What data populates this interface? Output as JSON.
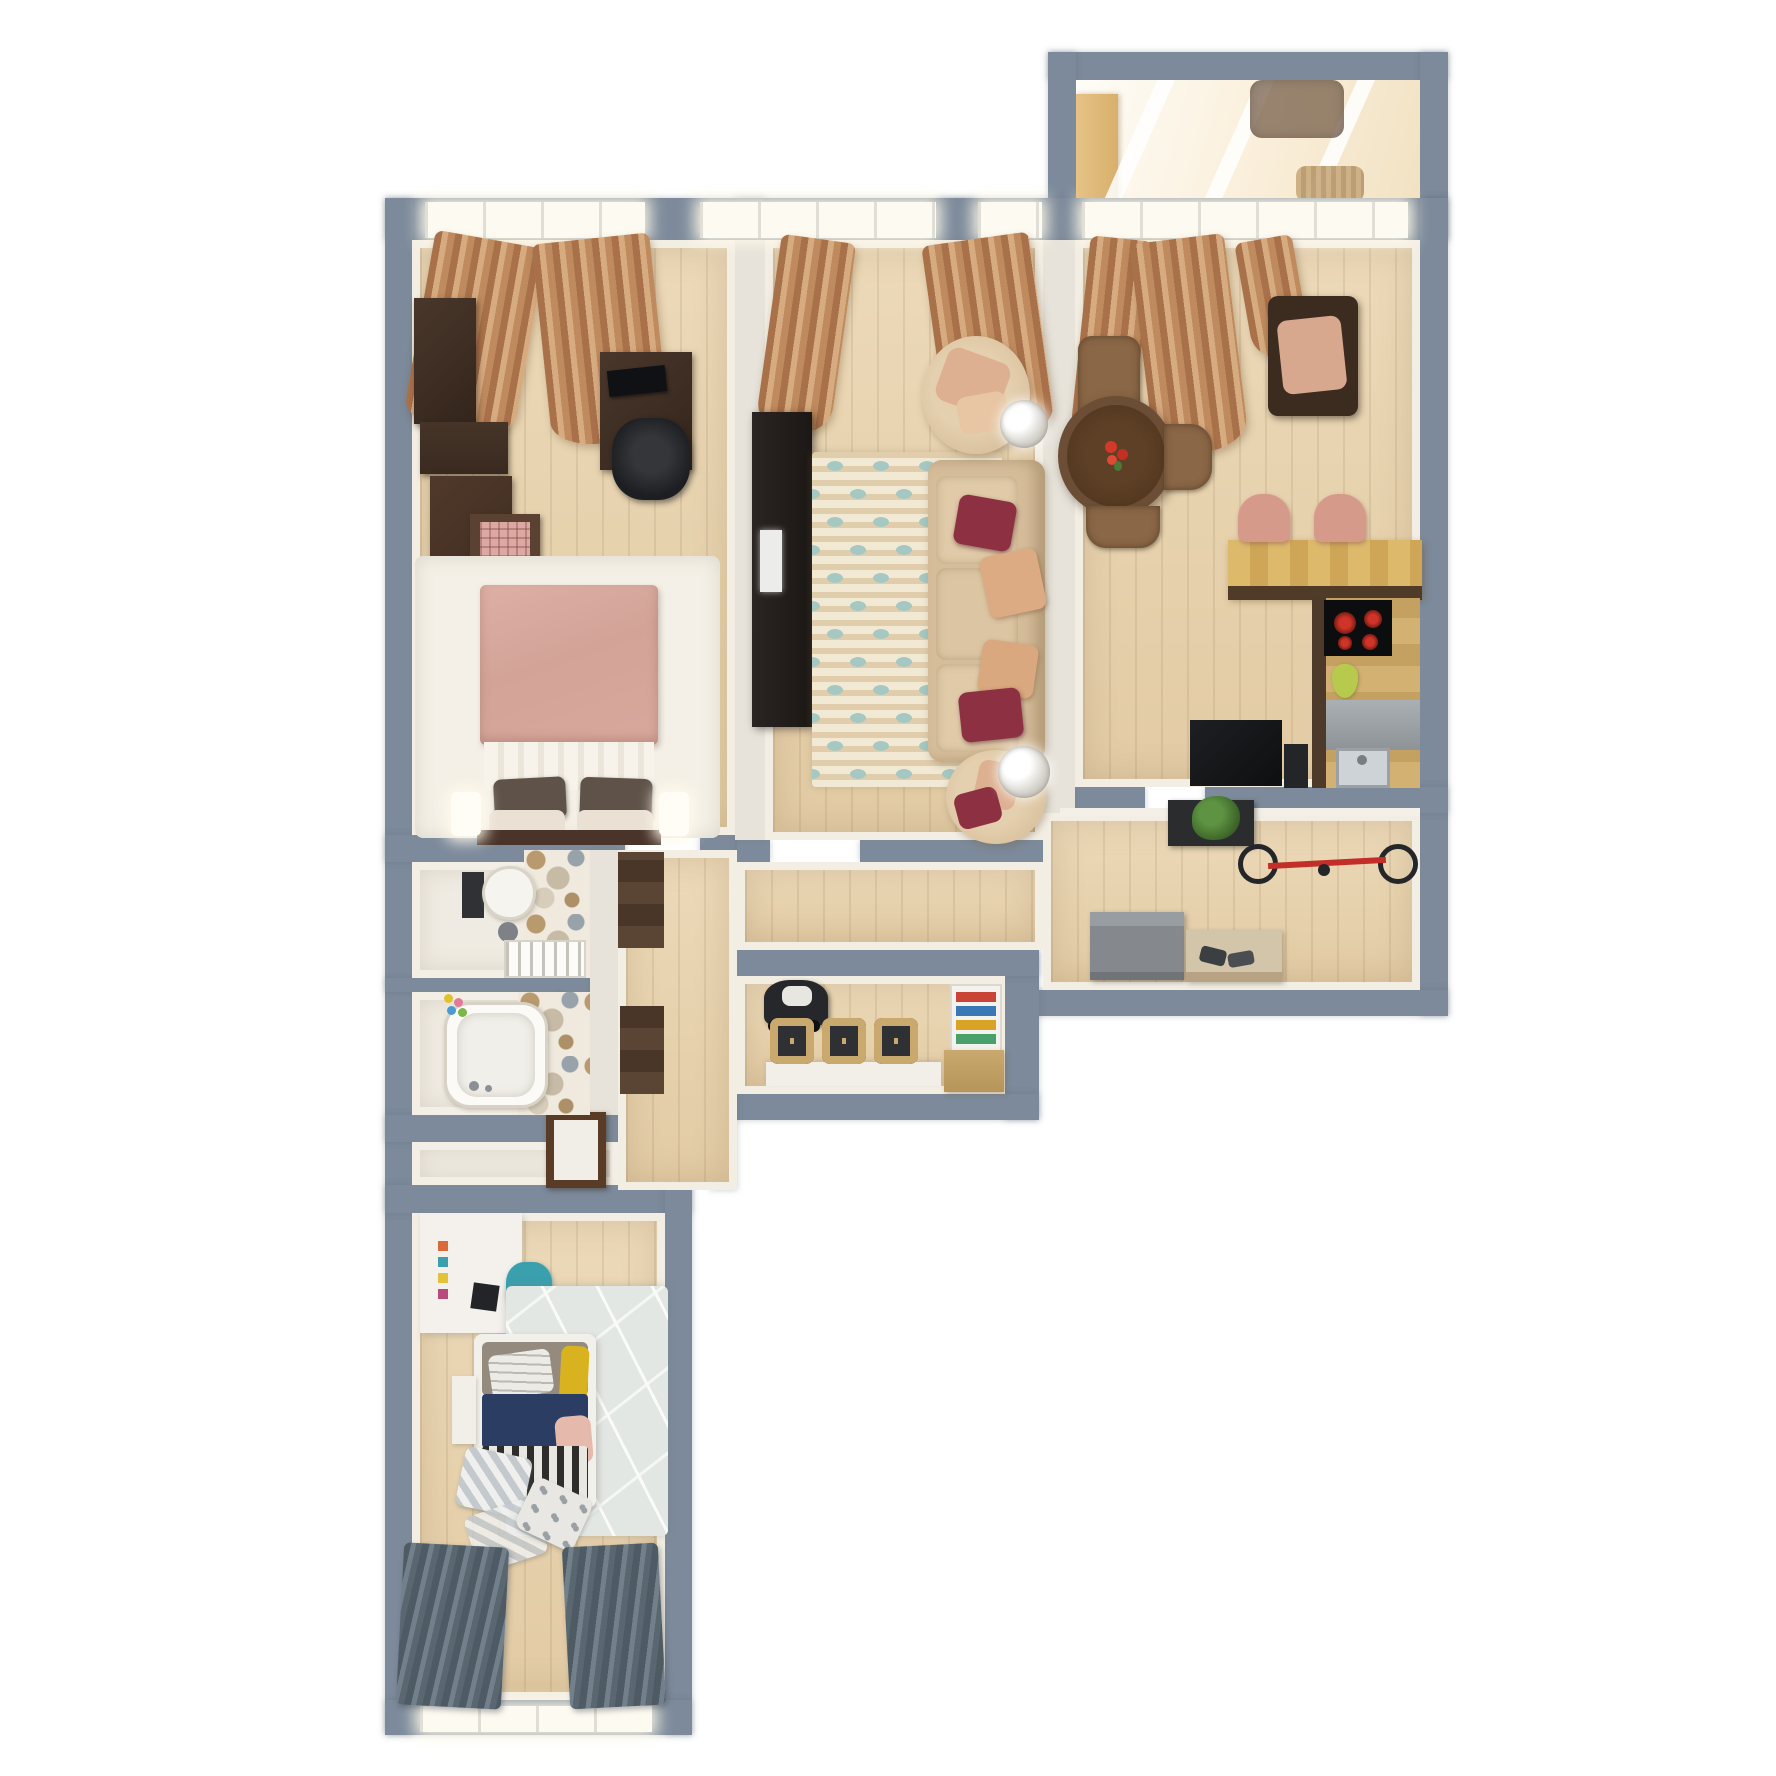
{
  "meta": {
    "type": "3d-apartment-floor-plan-render",
    "view": "top-down",
    "canvas": {
      "width": 1776,
      "height": 1776
    },
    "background": "#ffffff",
    "visible_text": ""
  },
  "palette": {
    "exterior_wall": "#7c8a9b",
    "interior_partition": "#e7e3da",
    "wood_floor": "#ead7b5",
    "tile_floor": "#f0ebe2",
    "window_glow": "#fdfaf1",
    "curtain_tan": "#bf8a5d",
    "curtain_dark_gray": "#5a6771",
    "living_rug_base": "#f1e9d4",
    "living_rug_teal": "#a5c8c3",
    "sofa_beige": "#d6bd9a",
    "pillow_burgundy": "#8c3042",
    "pillow_blush": "#dcab84",
    "bed_pink_duvet": "#d8a89d",
    "bed_navy": "#2c3d63",
    "bed_yellow": "#d8b31f",
    "dark_wood_furniture": "#4a372b",
    "dining_table_brown": "#53381f",
    "chair_brown": "#8a6746",
    "bar_counter_wood": "#ddb96c",
    "appliance_black": "#121315",
    "cooktop_burner_red": "#d03428",
    "plant_green": "#4c7c36",
    "bike_red": "#c22f28",
    "teal_chair": "#3aa0ae",
    "kids_rug_gray": "#e3e7e4",
    "hex_tile_tan": "#b99a6f",
    "hex_tile_gray": "#97a2ab"
  },
  "rooms": [
    {
      "id": "balcony",
      "position": "top-right",
      "furniture": [
        "storage-cabinet",
        "lounge-chair",
        "wicker-basket",
        "window-mullions"
      ]
    },
    {
      "id": "bedroom-1",
      "position": "top-left",
      "furniture": [
        "wardrobe",
        "wall-shelf",
        "dresser",
        "pink-nightstand",
        "double-bed",
        "pink-duvet",
        "dark-pillows",
        "white-pillows",
        "bedside-lamps",
        "desk",
        "monitor",
        "office-chair",
        "white-rug",
        "tan-curtains"
      ]
    },
    {
      "id": "living-room",
      "position": "top-center",
      "furniture": [
        "tv-console",
        "tv",
        "patterned-rug",
        "three-seat-sofa",
        "burgundy-pillows",
        "blush-pillows",
        "round-armchair-top",
        "round-armchair-bottom",
        "crystal-lamps",
        "tan-curtains"
      ]
    },
    {
      "id": "kitchen-dining",
      "position": "top-right-main",
      "furniture": [
        "brown-armchair",
        "round-dining-table",
        "red-flower-centerpiece",
        "dining-chairs",
        "window-armchair",
        "bar-counter",
        "pink-bar-stools",
        "cooktop",
        "pear",
        "dishwasher",
        "sink",
        "refrigerator",
        "waste-bin",
        "tan-curtains"
      ]
    },
    {
      "id": "hallway",
      "position": "center-right",
      "furniture": [
        "console-with-plant",
        "wall-mounted-bicycle",
        "shoe-cabinet",
        "bench-with-shoes"
      ]
    },
    {
      "id": "utility-room",
      "position": "center",
      "furniture": [
        "stroller",
        "row-of-chairs",
        "white-desk-strip",
        "bookshelf-with-colorful-books",
        "wood-desk"
      ]
    },
    {
      "id": "wc",
      "position": "mid-left",
      "furniture": [
        "toilet",
        "hex-mosaic-wall",
        "waste-bin",
        "radiator"
      ]
    },
    {
      "id": "bathroom",
      "position": "mid-left-lower",
      "furniture": [
        "bathtub",
        "hex-mosaic-wall",
        "bath-toys",
        "open-door"
      ]
    },
    {
      "id": "entry-hall",
      "position": "lower-center-left",
      "furniture": [
        "front-door",
        "corridor-wardrobe-upper",
        "corridor-wardrobe-lower"
      ]
    },
    {
      "id": "bedroom-2",
      "position": "bottom-left",
      "furniture": [
        "white-desk",
        "art-supplies",
        "teal-chair",
        "geometric-rug",
        "single-bed",
        "gray-pillow",
        "striped-pillow",
        "yellow-pillow",
        "navy-blanket",
        "pink-throw",
        "striped-blanket",
        "checkered-pillow-pile",
        "bedside-shelf",
        "dark-striped-curtains",
        "window"
      ]
    }
  ]
}
